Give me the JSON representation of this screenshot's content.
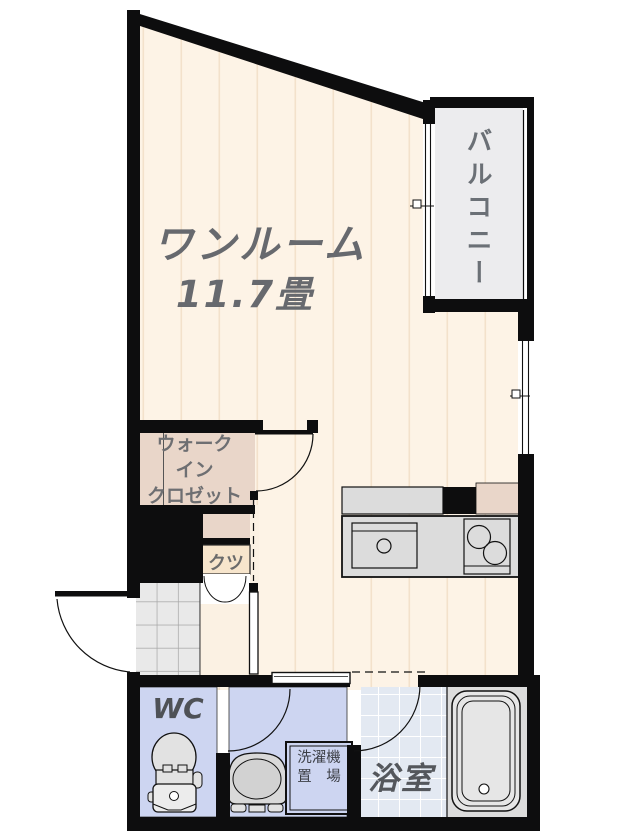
{
  "floor_plan": {
    "main_room": {
      "label": "ワンルーム",
      "size": "11.7畳"
    },
    "balcony": {
      "label": "バルコニー"
    },
    "closet": {
      "label": "ウォーク\nイン\nクロゼット"
    },
    "shoes": {
      "label": "クツ"
    },
    "wc": {
      "label": "WC"
    },
    "laundry": {
      "label": "洗濯機\n置　場"
    },
    "bathroom": {
      "label": "浴室"
    },
    "colors": {
      "wall": "#0d0d0e",
      "floor": "#fdf3e6",
      "floor_stripe": "#f3e1cb",
      "closet_pink": "#e9d6c9",
      "shoes_tan": "#f7e5cc",
      "wet_area_blue": "#cdd5f1",
      "bath_tile": "#e3e9f2",
      "balcony_gray": "#ececee",
      "fixture_gray": "#dcdcdc",
      "genkan_tile": "#e9e9e9",
      "label_gray": "#65676c"
    }
  }
}
